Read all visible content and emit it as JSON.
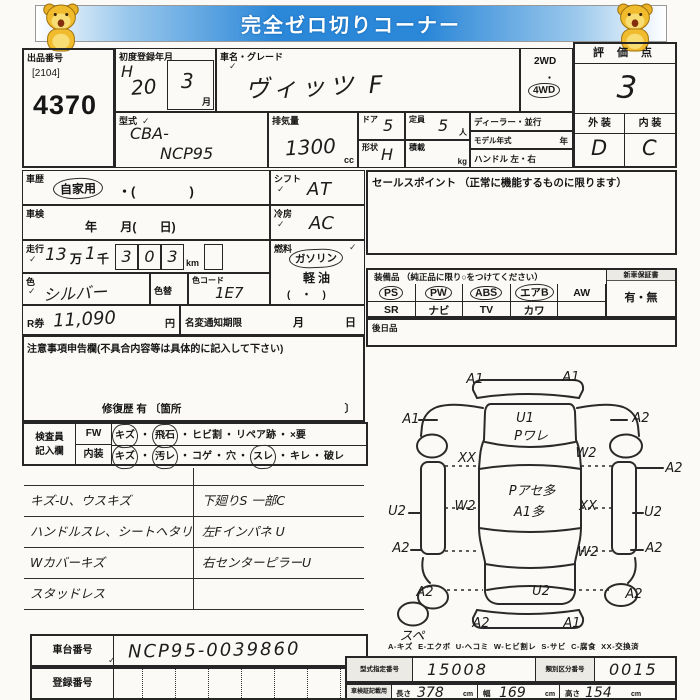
{
  "banner": {
    "title": "完全ゼロ切りコーナー"
  },
  "marks": {
    "check": "✓"
  },
  "header": {
    "auction_no_label": "出品番号",
    "auction_no_sub": "[2104]",
    "auction_no": "4370",
    "first_reg_label": "初度登録年月",
    "first_reg_era": "H",
    "first_reg_year": "20",
    "first_reg_month": "3",
    "month_suffix": "月",
    "car_name_label": "車名・グレード",
    "car_name": "ヴィッツ F",
    "drive_2wd": "2WD",
    "drive_sep": "・",
    "drive_4wd": "4WD",
    "score_label": "評 価 点",
    "score": "3",
    "exterior_label": "外 装",
    "interior_label": "内 装",
    "exterior_grade": "D",
    "interior_grade": "C",
    "model_code_label": "型式",
    "model_code_1": "CBA-",
    "model_code_2": "NCP95",
    "displacement_label": "排気量",
    "displacement": "1300",
    "displacement_unit": "cc",
    "doors_label": "ドア",
    "doors": "5",
    "capacity_label": "定員",
    "capacity": "5",
    "capacity_unit": "人",
    "shape_label": "形状",
    "shape": "H",
    "load_label": "積載",
    "load_unit": "kg",
    "dealer_label": "ディーラー・並行",
    "model_year_label": "モデル年式",
    "model_year_unit": "年",
    "handle_label": "ハンドル 左・右"
  },
  "left": {
    "history_label": "車歴",
    "history_value": "自家用",
    "history_paren": "・(               )",
    "shift_label": "シフト",
    "shift_value": "AT",
    "inspection_label": "車検",
    "inspection_fields": "年       月(       日)",
    "ac_label": "冷房",
    "ac_value": "AC",
    "mileage_label": "走行",
    "mileage_man": "13",
    "man_label": "万",
    "mileage_sen": "1",
    "sen_label": "千",
    "mileage_digits": [
      "3",
      "0",
      "3"
    ],
    "mileage_unit": "km",
    "fuel_label": "燃料",
    "fuel_gasoline": "ガソリン",
    "fuel_diesel": "軽油",
    "fuel_paren": "(    ・    )",
    "color_label": "色",
    "color_value": "シルバー",
    "color_change_label": "色替",
    "color_code_label": "色コード",
    "color_code": "1E7",
    "rticket_label": "R券",
    "rticket_value": "11,090",
    "yen": "円",
    "name_change_label": "名変通知期限",
    "month_label": "月",
    "day_label": "日",
    "notes_header": "注意事項申告欄(不具合内容等は具体的に記入して下さい)",
    "repair_label": "修復歴    有 〔箇所",
    "repair_close": "〕",
    "inspector_label_1": "検査員",
    "inspector_label_2": "記入欄",
    "fw_label": "FW",
    "fw_items": [
      {
        "text": "キズ",
        "circled": true
      },
      {
        "text": "飛石",
        "circled": true
      },
      {
        "text": "ヒビ割",
        "circled": false
      },
      {
        "text": "リペア跡",
        "circled": false
      },
      {
        "text": "×要",
        "circled": false
      }
    ],
    "interior_row_label": "内装",
    "interior_items": [
      {
        "text": "キズ",
        "circled": true
      },
      {
        "text": "汚レ",
        "circled": true
      },
      {
        "text": "コゲ",
        "circled": false
      },
      {
        "text": "穴",
        "circled": false
      },
      {
        "text": "スレ",
        "circled": true
      },
      {
        "text": "キレ",
        "circled": false
      },
      {
        "text": "破レ",
        "circled": false
      }
    ]
  },
  "sales_point": {
    "header": "セールスポイント （正常に機能するものに限ります）"
  },
  "equipment": {
    "header": "装備品 （純正品に限り○をつけてください）",
    "row1": [
      {
        "text": "PS",
        "circled": true
      },
      {
        "text": "PW",
        "circled": true
      },
      {
        "text": "ABS",
        "circled": true
      },
      {
        "text": "エアB",
        "circled": true
      },
      {
        "text": "AW",
        "circled": false
      }
    ],
    "row2": [
      {
        "text": "SR",
        "circled": false
      },
      {
        "text": "ナビ",
        "circled": false
      },
      {
        "text": "TV",
        "circled": false
      },
      {
        "text": "カワ",
        "circled": false
      },
      {
        "text": "",
        "circled": false
      }
    ],
    "warranty_label": "新車保証書",
    "warranty_value": "有・無",
    "later_label": "後日品"
  },
  "notes": {
    "left": [
      "キズ-U、ウスキズ",
      "ハンドルスレ、シートヘタリ",
      "Wカバーキズ",
      "スタッドレス"
    ],
    "right": [
      "下廻りS 一部C",
      "左Fインパネ U",
      "右センターピラーU"
    ]
  },
  "diagram": {
    "labels": [
      {
        "t": "A1",
        "x": 100,
        "y": 17
      },
      {
        "t": "A1",
        "x": 196,
        "y": 15
      },
      {
        "t": "A1",
        "x": 36,
        "y": 57
      },
      {
        "t": "U1",
        "x": 150,
        "y": 56
      },
      {
        "t": "Pワレ",
        "x": 156,
        "y": 74
      },
      {
        "t": "A2",
        "x": 266,
        "y": 56
      },
      {
        "t": "XX",
        "x": 92,
        "y": 96
      },
      {
        "t": "W2",
        "x": 211,
        "y": 91
      },
      {
        "t": "A2",
        "x": 299,
        "y": 106
      },
      {
        "t": "U2",
        "x": 22,
        "y": 149
      },
      {
        "t": "W2",
        "x": 90,
        "y": 144
      },
      {
        "t": "Pアセ多",
        "x": 157,
        "y": 129
      },
      {
        "t": "A1多",
        "x": 154,
        "y": 150
      },
      {
        "t": "XX",
        "x": 213,
        "y": 144
      },
      {
        "t": "U2",
        "x": 278,
        "y": 150
      },
      {
        "t": "A2",
        "x": 26,
        "y": 186
      },
      {
        "t": "W2",
        "x": 213,
        "y": 190
      },
      {
        "t": "A2",
        "x": 279,
        "y": 186
      },
      {
        "t": "A2",
        "x": 50,
        "y": 230
      },
      {
        "t": "U2",
        "x": 166,
        "y": 229
      },
      {
        "t": "A2",
        "x": 259,
        "y": 232
      },
      {
        "t": "A2",
        "x": 106,
        "y": 261
      },
      {
        "t": "A1",
        "x": 197,
        "y": 261
      },
      {
        "t": "スペ",
        "x": 37,
        "y": 274,
        "s": 9
      }
    ]
  },
  "legend": "A-キズ  E-エクボ  U-ヘコミ  W-ヒビ割レ  S-サビ  C-腐食  XX-交換済",
  "footer": {
    "chassis_label": "車台番号",
    "chassis_value": "NCP95-0039860",
    "reg_label": "登録番号",
    "type_cert_label": "型式指定番号",
    "type_cert_value": "15008",
    "class_label": "類別区分番号",
    "class_value": "0015",
    "dims_label": "車検証記載用",
    "length_label": "長さ",
    "length_value": "378",
    "width_label": "幅",
    "width_value": "169",
    "height_label": "高さ",
    "height_value": "154",
    "cm": "cm"
  }
}
